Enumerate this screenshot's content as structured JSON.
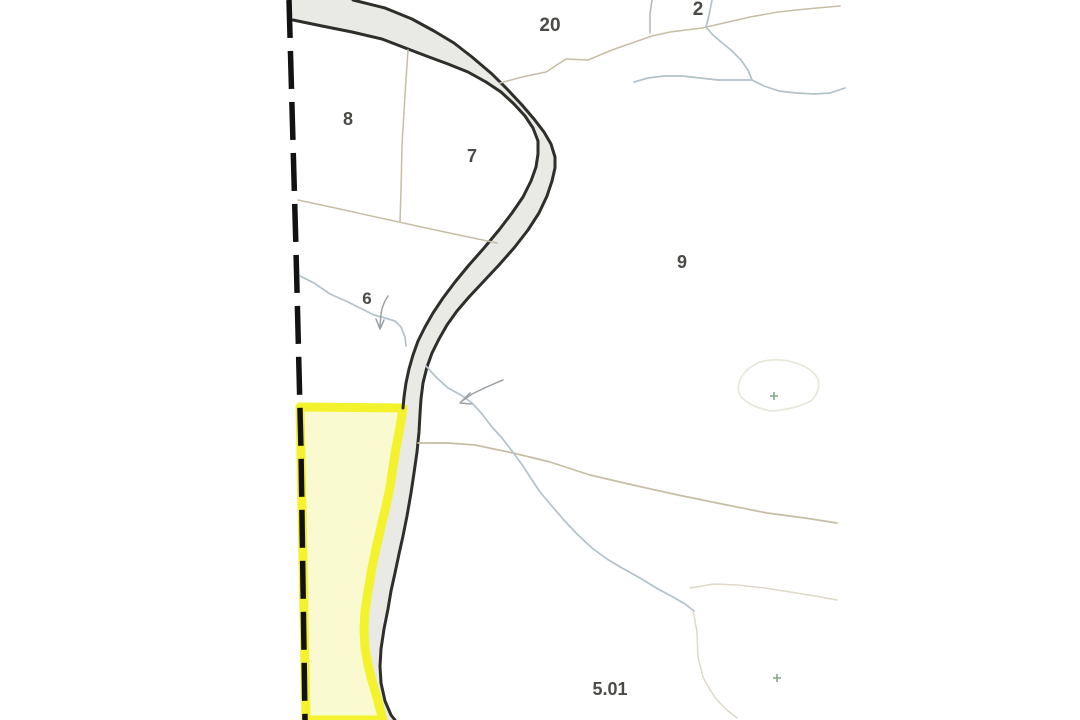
{
  "map": {
    "kind": "tax-parcel-map",
    "parcel_labels": [
      {
        "label": "20"
      },
      {
        "label": "2"
      },
      {
        "label": "8"
      },
      {
        "label": "7"
      },
      {
        "label": "6"
      },
      {
        "label": "9"
      },
      {
        "label": "5.01"
      }
    ],
    "highlighted_parcel_adjacent_to": "road corridor"
  },
  "colors": {
    "background": "#ffffff",
    "road_fill": "#e9e9e5",
    "road_edge": "#2e2e2a",
    "boundary_dashed": "#121212",
    "parcel_line": "#c6bea4",
    "parcel_line_faint": "#ddd8c5",
    "divider_gray": "#b5b5af",
    "stream": "#b3c1c9",
    "pond": "#e5e8da",
    "marker_green": "#84a78a",
    "arrow": "#9aa0a4",
    "label": "#4a4a46",
    "highlight_fill": "#fafad1",
    "highlight_stroke": "#f4f22d"
  }
}
